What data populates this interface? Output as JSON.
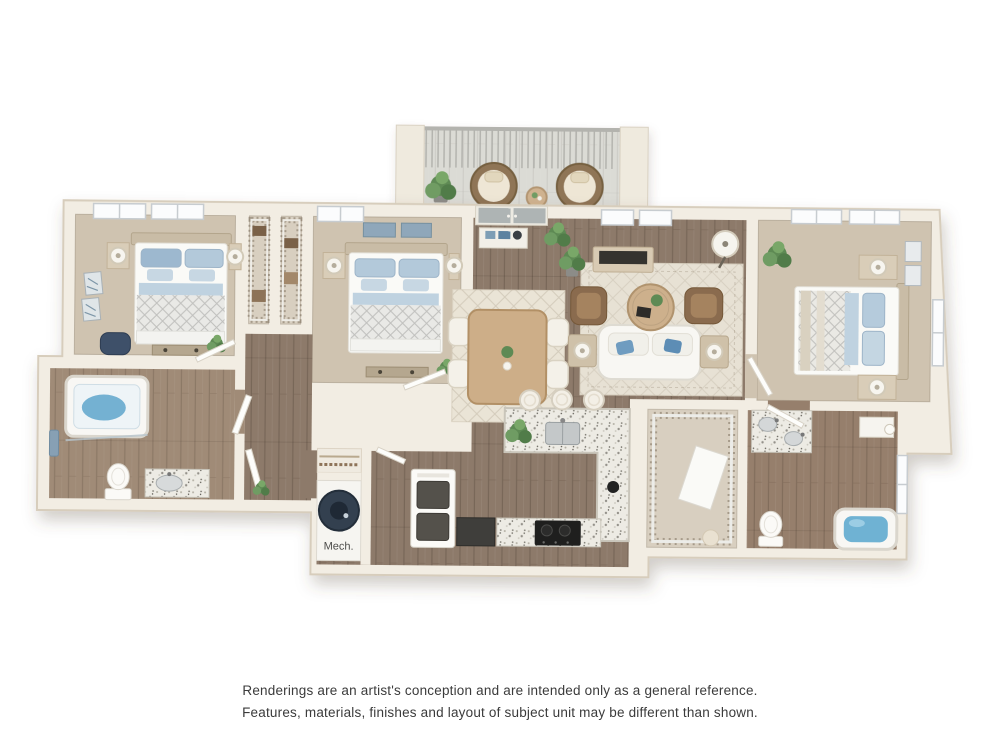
{
  "page": {
    "background_color": "#ffffff"
  },
  "floorplan": {
    "type": "3d-rendered-floor-plan",
    "mech_label": "Mech.",
    "colors": {
      "wall": "#f2ede3",
      "wall_edge": "#d7cdbc",
      "carpet": "#cfc3b0",
      "carpet_closet": "#d8cfc0",
      "wood": "#8d7a6a",
      "wood_light": "#a08b77",
      "granite": "#edebe4",
      "rug": "#eae4d6",
      "water_blue": "#74b1d2",
      "pillow_blue": "#9db8cf",
      "plant_green": "#5e8a54",
      "chair_brown": "#8a6b4e",
      "deck_gray": "#dbdbd5",
      "appliance_dark": "#3f3e3b",
      "heater_navy": "#33404f"
    }
  },
  "disclaimer": {
    "line1": "Renderings are an artist's conception and are intended only as a general reference.",
    "line2": "Features, materials, finishes and layout of subject unit may be different than shown."
  }
}
